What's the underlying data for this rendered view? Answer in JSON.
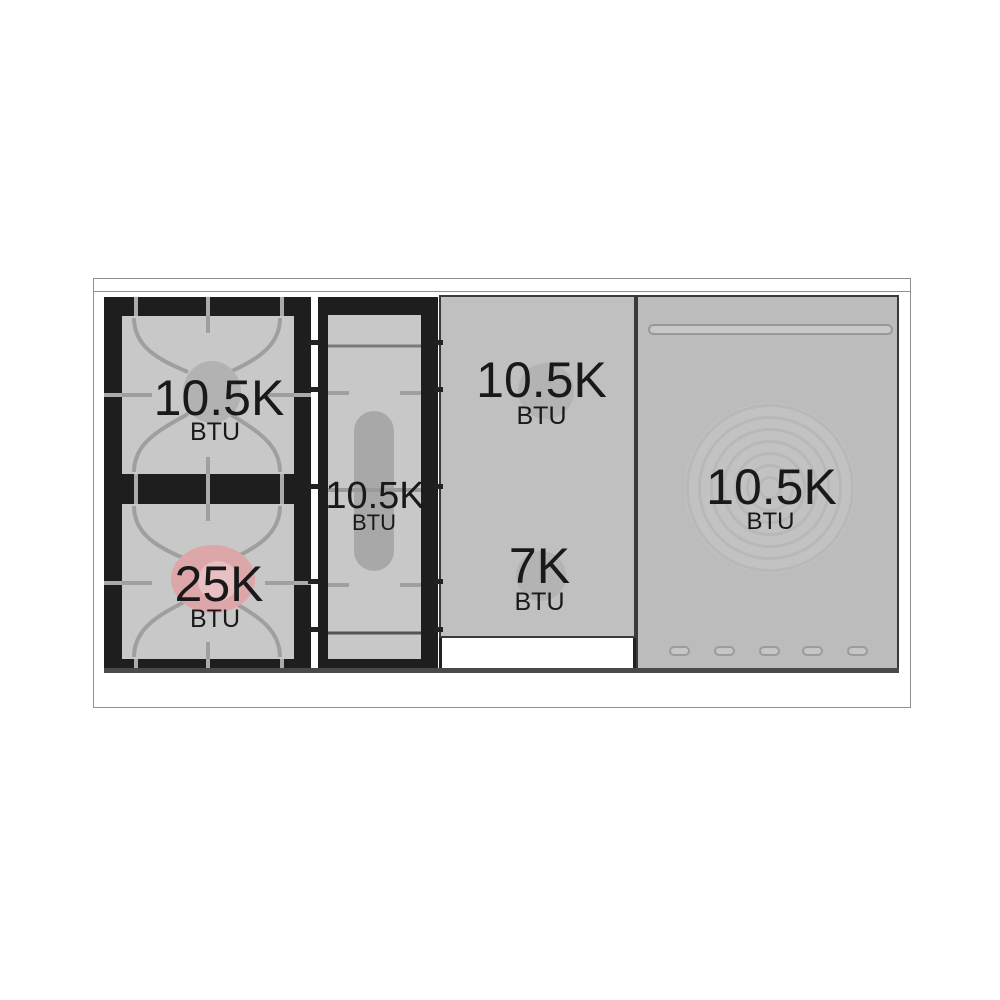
{
  "figure": {
    "title": "Range cooktop burner power diagram",
    "unit_label": "BTU"
  },
  "burners": [
    {
      "id": "left-rear",
      "zone": "left double-burner module, rear",
      "power": "10.5K",
      "unit": "BTU",
      "highlighted": false
    },
    {
      "id": "left-front",
      "zone": "left double-burner module, front",
      "power": "25K",
      "unit": "BTU",
      "highlighted": true
    },
    {
      "id": "center-oval",
      "zone": "center oval burner module",
      "power": "10.5K",
      "unit": "BTU",
      "highlighted": false
    },
    {
      "id": "griddle-rear",
      "zone": "griddle plate, rear zone",
      "power": "10.5K",
      "unit": "BTU",
      "highlighted": false
    },
    {
      "id": "griddle-front",
      "zone": "griddle plate, front zone",
      "power": "7K",
      "unit": "BTU",
      "highlighted": false
    },
    {
      "id": "french-top",
      "zone": "right french-top ring plate",
      "power": "10.5K",
      "unit": "BTU",
      "highlighted": false
    }
  ],
  "colors": {
    "text": "#191919",
    "frame": "#909090",
    "module_black": "#1e1e1e",
    "burner_box_gray": "#c8c8c8",
    "plate": "#c0c0c0",
    "panel": "#bcbcbc",
    "grate_line": "#9f9f9f",
    "burner_cap_gray": "#b2b2b2",
    "oval_capsule": "#a8a8a8",
    "highlight_pink": "#dda6a9",
    "highlight_pink_inner": "#e6c0c2",
    "ring_a": "#c2c2c2",
    "ring_b": "#b8b8b8"
  }
}
